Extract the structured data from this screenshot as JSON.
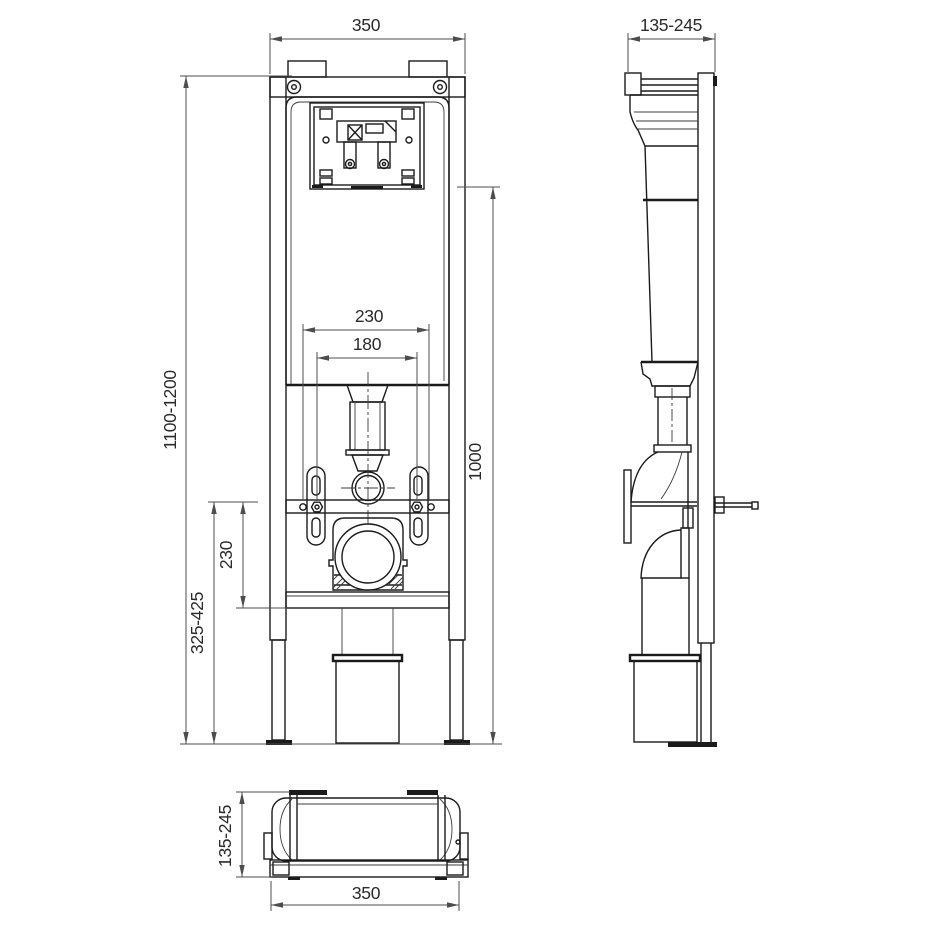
{
  "colors": {
    "line": "#1b1b1b",
    "dimension": "#4d4d4d",
    "text": "#2a2a2a",
    "background": "#ffffff"
  },
  "dimensions": {
    "front_width": "350",
    "side_depth": "135-245",
    "frame_height": "1100-1200",
    "stud_spacing_outer": "230",
    "stud_spacing_inner": "180",
    "cistern_height": "1000",
    "outlet_offset": "230",
    "outlet_height": "325-425",
    "plan_depth": "135-245",
    "plan_width": "350"
  }
}
